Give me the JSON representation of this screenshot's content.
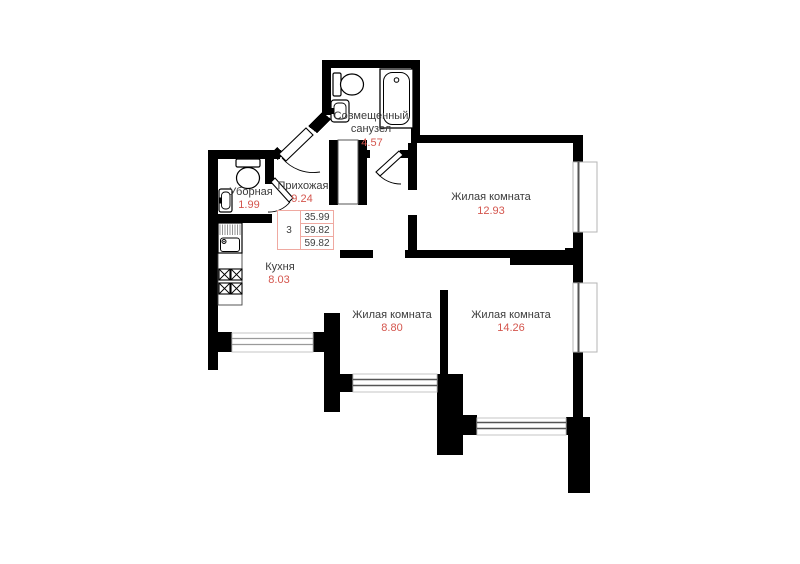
{
  "plan": {
    "rooms": [
      {
        "name_lines": [
          "Совмещенный",
          "санузел"
        ],
        "name": "Совмещенный санузел",
        "area": "4.57"
      },
      {
        "name": "Уборная",
        "area": "1.99"
      },
      {
        "name": "Прихожая",
        "area": "9.24"
      },
      {
        "name": "Кухня",
        "area": "8.03"
      },
      {
        "name": "Жилая комната",
        "area": "12.93"
      },
      {
        "name": "Жилая комната",
        "area": "8.80"
      },
      {
        "name": "Жилая комната",
        "area": "14.26"
      }
    ],
    "summary_table": {
      "rooms_count": "3",
      "areas": [
        "35.99",
        "59.82",
        "59.82"
      ]
    },
    "fixtures": [
      "bathtub",
      "toilet",
      "washbasin",
      "toilet",
      "washbasin",
      "kitchen-sink",
      "stove"
    ],
    "colors": {
      "wall": "#000000",
      "room_name": "#3b3b3b",
      "area_value": "#d4564e",
      "table_border": "#efa9a1",
      "window_glazing": "#555555",
      "window_frame": "#b5b5b5"
    }
  }
}
